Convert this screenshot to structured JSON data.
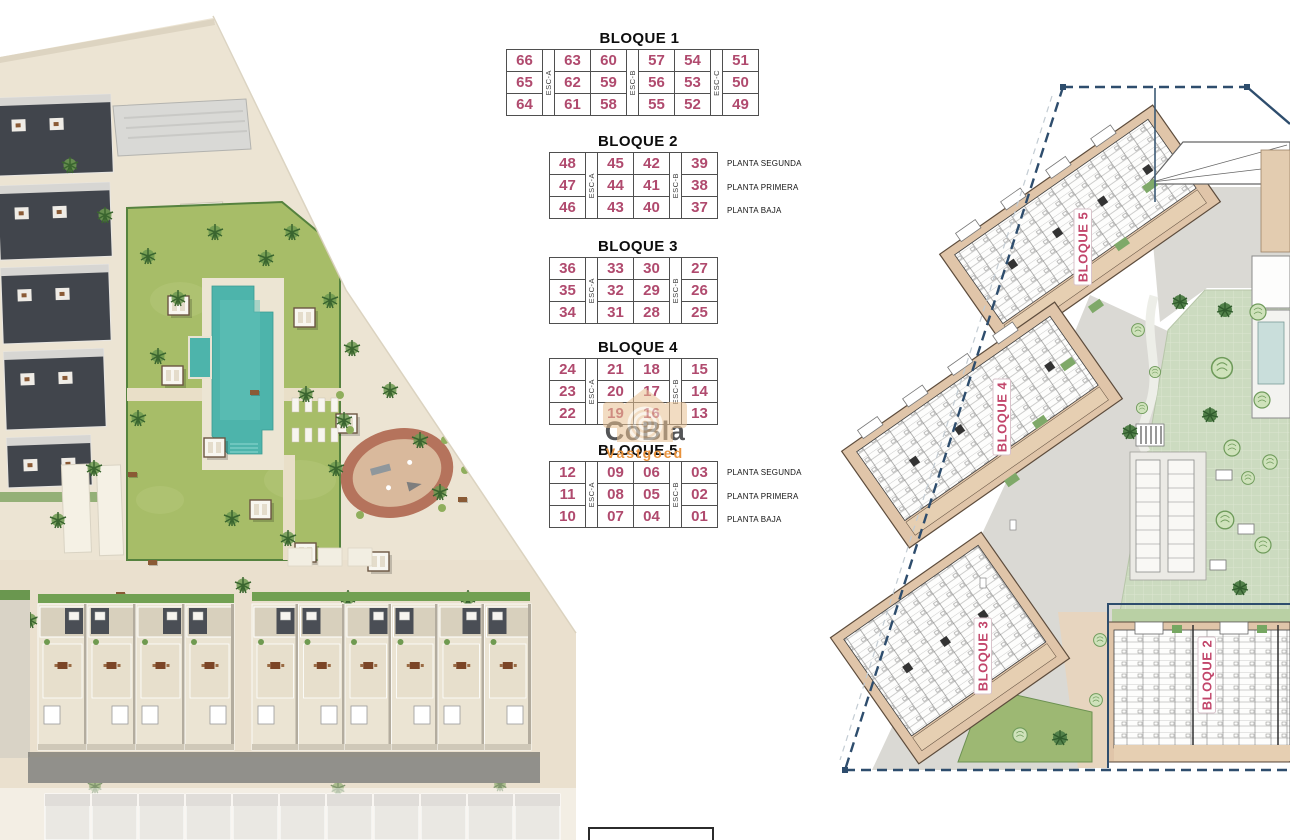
{
  "watermark": {
    "brand": "CoBla",
    "sub": "Vastgoed"
  },
  "floor_labels": [
    "PLANTA SEGUNDA",
    "PLANTA PRIMERA",
    "PLANTA BAJA"
  ],
  "blocks": [
    {
      "title": "BLOQUE 1",
      "stairs": [
        "ESC-A",
        "ESC-B",
        "ESC-C"
      ],
      "layout": [
        1,
        2,
        2,
        1
      ],
      "show_floors": false,
      "rows": [
        [
          "66",
          "63",
          "60",
          "57",
          "54",
          "51"
        ],
        [
          "65",
          "62",
          "59",
          "56",
          "53",
          "50"
        ],
        [
          "64",
          "61",
          "58",
          "55",
          "52",
          "49"
        ]
      ]
    },
    {
      "title": "BLOQUE 2",
      "stairs": [
        "ESC-A",
        "ESC-B"
      ],
      "layout": [
        1,
        2,
        1
      ],
      "show_floors": true,
      "rows": [
        [
          "48",
          "45",
          "42",
          "39"
        ],
        [
          "47",
          "44",
          "41",
          "38"
        ],
        [
          "46",
          "43",
          "40",
          "37"
        ]
      ]
    },
    {
      "title": "BLOQUE 3",
      "stairs": [
        "ESC-A",
        "ESC-B"
      ],
      "layout": [
        1,
        2,
        1
      ],
      "show_floors": false,
      "rows": [
        [
          "36",
          "33",
          "30",
          "27"
        ],
        [
          "35",
          "32",
          "29",
          "26"
        ],
        [
          "34",
          "31",
          "28",
          "25"
        ]
      ]
    },
    {
      "title": "BLOQUE 4",
      "stairs": [
        "ESC-A",
        "ESC-B"
      ],
      "layout": [
        1,
        2,
        1
      ],
      "show_floors": false,
      "rows": [
        [
          "24",
          "21",
          "18",
          "15"
        ],
        [
          "23",
          "20",
          "17",
          "14"
        ],
        [
          "22",
          "19",
          "16",
          "13"
        ]
      ]
    },
    {
      "title": "BLOQUE 5",
      "stairs": [
        "ESC-A",
        "ESC-B"
      ],
      "layout": [
        1,
        2,
        1
      ],
      "show_floors": true,
      "rows": [
        [
          "12",
          "09",
          "06",
          "03"
        ],
        [
          "11",
          "08",
          "05",
          "02"
        ],
        [
          "10",
          "07",
          "04",
          "01"
        ]
      ]
    }
  ],
  "site_plan": {
    "labels": [
      "BLOQUE 5",
      "BLOQUE 4",
      "BLOQUE 3",
      "BLOQUE 2"
    ]
  }
}
